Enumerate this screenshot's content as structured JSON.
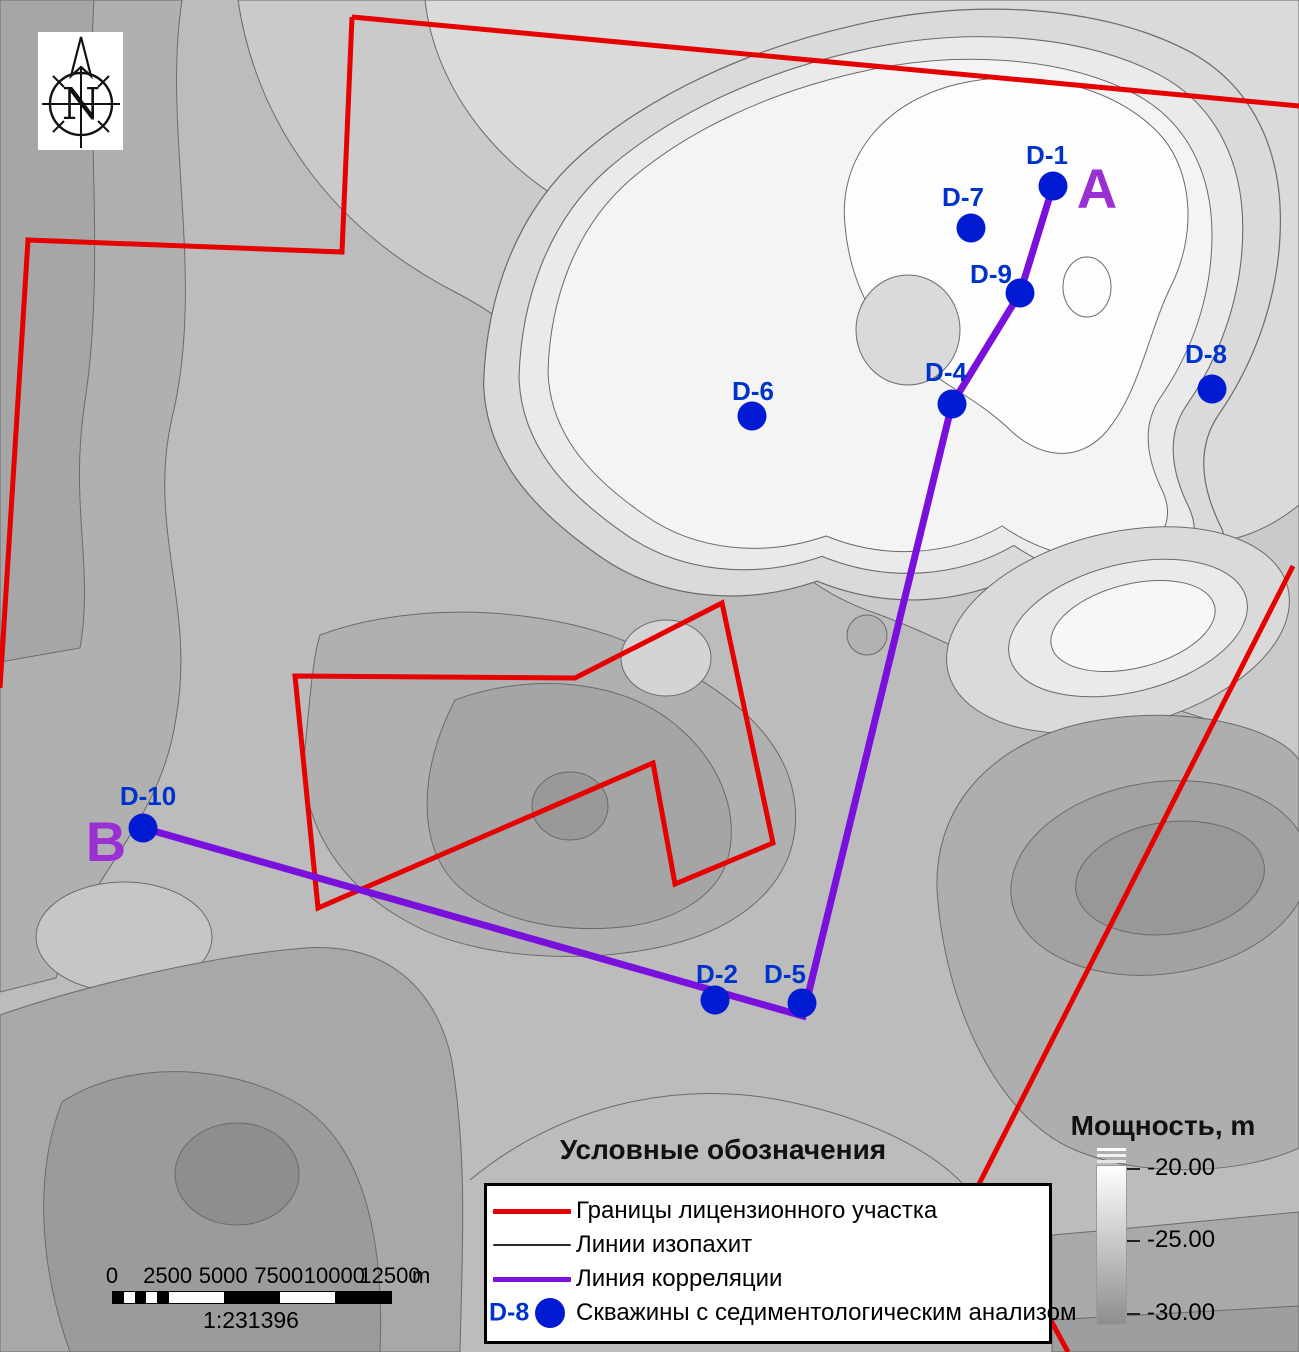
{
  "compass": {
    "letter": "N"
  },
  "colors": {
    "boundary": "#e60000",
    "correlation": "#7a10dc",
    "well_dot": "#001bd2",
    "well_label": "#0033cc",
    "section_letter": "#9a2fd4",
    "contour_line": "#6b6b6b",
    "thickness_top": "#ffffff",
    "thickness_bottom": "#8e8e8e"
  },
  "wells": [
    {
      "id": "D-1",
      "x": 1053,
      "y": 186,
      "label_x": 1047,
      "label_y": 164
    },
    {
      "id": "D-7",
      "x": 971,
      "y": 228,
      "label_x": 963,
      "label_y": 206
    },
    {
      "id": "D-9",
      "x": 1020,
      "y": 293,
      "label_x": 991,
      "label_y": 283
    },
    {
      "id": "D-4",
      "x": 952,
      "y": 404,
      "label_x": 946,
      "label_y": 381
    },
    {
      "id": "D-6",
      "x": 752,
      "y": 416,
      "label_x": 753,
      "label_y": 400
    },
    {
      "id": "D-8",
      "x": 1212,
      "y": 389,
      "label_x": 1206,
      "label_y": 363
    },
    {
      "id": "D-10",
      "x": 143,
      "y": 828,
      "label_x": 148,
      "label_y": 805
    },
    {
      "id": "D-2",
      "x": 715,
      "y": 1000,
      "label_x": 717,
      "label_y": 983
    },
    {
      "id": "D-5",
      "x": 802,
      "y": 1003,
      "label_x": 785,
      "label_y": 983
    }
  ],
  "section": {
    "start_label": "A",
    "start_x": 1097,
    "start_y": 208,
    "end_label": "B",
    "end_x": 106,
    "end_y": 861,
    "path": [
      [
        1053,
        186
      ],
      [
        1020,
        293
      ],
      [
        952,
        404
      ],
      [
        803,
        1016
      ],
      [
        143,
        828
      ]
    ]
  },
  "legend": {
    "title": "Условные обозначения",
    "items": [
      {
        "kind": "line",
        "label": "Границы лицензионного участка",
        "color": "#e60000",
        "thickness": 5
      },
      {
        "kind": "line",
        "label": "Линии изопахит",
        "color": "#2a2a2a",
        "thickness": 2
      },
      {
        "kind": "line",
        "label": "Линия корреляции",
        "color": "#7a10dc",
        "thickness": 5
      },
      {
        "kind": "well",
        "well_id": "D-8",
        "label": "Скважины с седиментологическим анализом"
      }
    ]
  },
  "thickness_scale": {
    "title": "Мощность, m",
    "ticks": [
      "-20.00",
      "-25.00",
      "-30.00"
    ]
  },
  "scale_bar": {
    "tick_labels": [
      "0",
      "2500",
      "5000",
      "7500",
      "10000",
      "12500"
    ],
    "unit_label": "m",
    "ratio_label": "1:231396"
  }
}
